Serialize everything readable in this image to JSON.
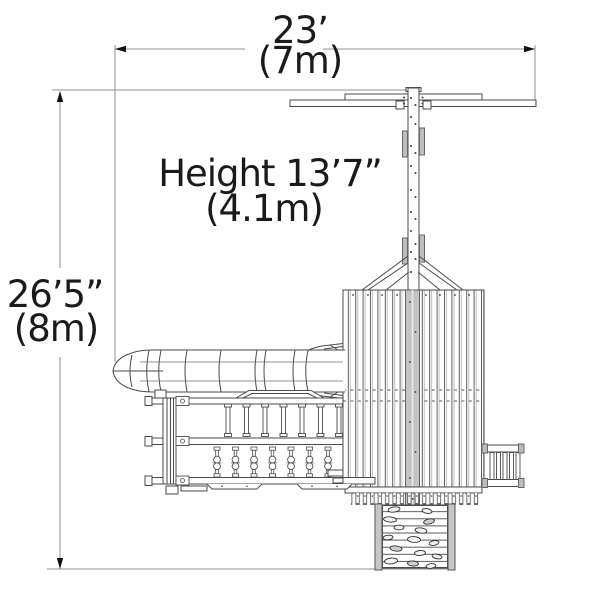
{
  "labels": {
    "width_imperial": "23’",
    "width_metric": "(7m)",
    "height": "Height 13’7”",
    "height_metric": "(4.1m)",
    "depth_imperial": "26’5”",
    "depth_metric": "(8m)"
  },
  "colors": {
    "background": "#ffffff",
    "line": "#4a4a4a",
    "dimension_line": "#909090",
    "arrow": "#111111",
    "text": "#1a1a1a",
    "shaded_fill": "#bdbdbd",
    "ridge_fill": "#c4c4c4"
  },
  "components": [
    "swing-crossbar",
    "swing-beam",
    "swing-hanger-pads",
    "a-frame-braces",
    "roof",
    "roof-ridge",
    "tube-slide",
    "deck-railing",
    "climber-posts",
    "access-ladder",
    "rock-climbing-wall"
  ]
}
